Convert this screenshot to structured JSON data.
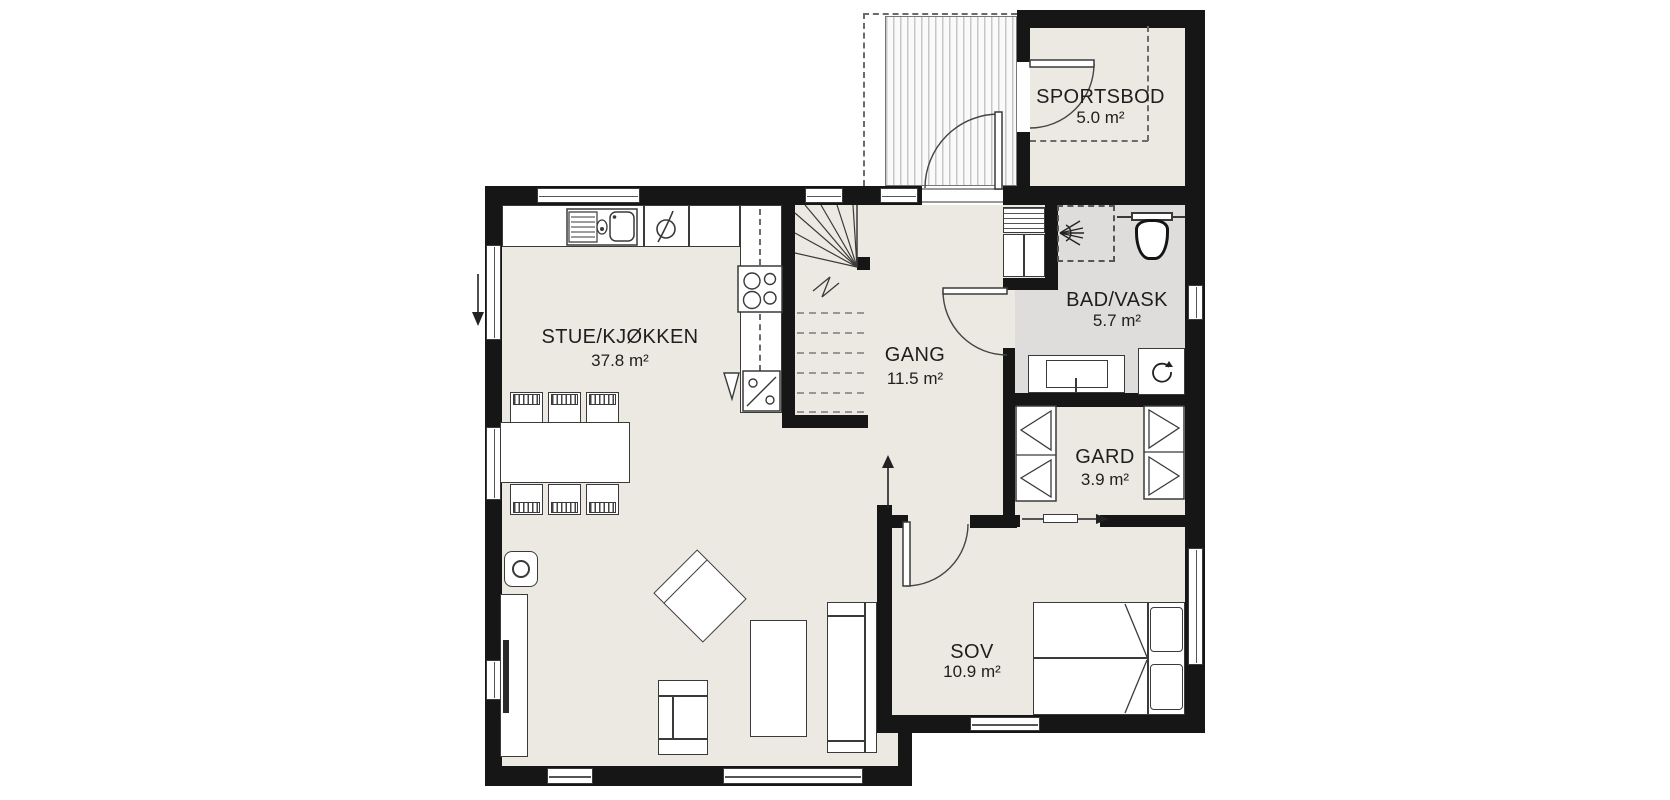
{
  "plan": {
    "title": "floor-plan",
    "rooms": [
      {
        "id": "stue-kjokken",
        "name": "STUE/KJØKKEN",
        "area": "37.8 m²"
      },
      {
        "id": "gang",
        "name": "GANG",
        "area": "11.5 m²"
      },
      {
        "id": "bad-vask",
        "name": "BAD/VASK",
        "area": "5.7 m²"
      },
      {
        "id": "gard",
        "name": "GARD",
        "area": "3.9 m²"
      },
      {
        "id": "sov",
        "name": "SOV",
        "area": "10.9 m²"
      },
      {
        "id": "sportsbod",
        "name": "SPORTSBOD",
        "area": "5.0 m²"
      }
    ],
    "colors": {
      "wall": "#161616",
      "floor": "#ebe9e1",
      "bath_floor": "#dedddb",
      "outline": "#3a3a3a",
      "deck_hatch": "#c7c7c7",
      "background": "#ffffff"
    },
    "icons": {
      "kitchen-sink": "double-basin-with-drainboard",
      "stove-symbol": "circle-with-diagonal",
      "cooktop": "four-burner-circles",
      "corner-cabinet": "diagonal-with-two-circles",
      "wood-stove": "circle-in-rounded-square",
      "stair": "winder-treads-with-break-line",
      "shower": "spray-fan-dashed-square",
      "toilet": "bowl-with-cistern",
      "vanity-sink": "rect-basin",
      "washing-machine": "square-rotate-arrow",
      "vent-grille": "horizontal-lines",
      "wardrobe": "triangle-hanger",
      "door": "quarter-circle-arc",
      "sliding-door": "arrow-with-panel",
      "direction-arrow": "straight-arrow"
    }
  }
}
